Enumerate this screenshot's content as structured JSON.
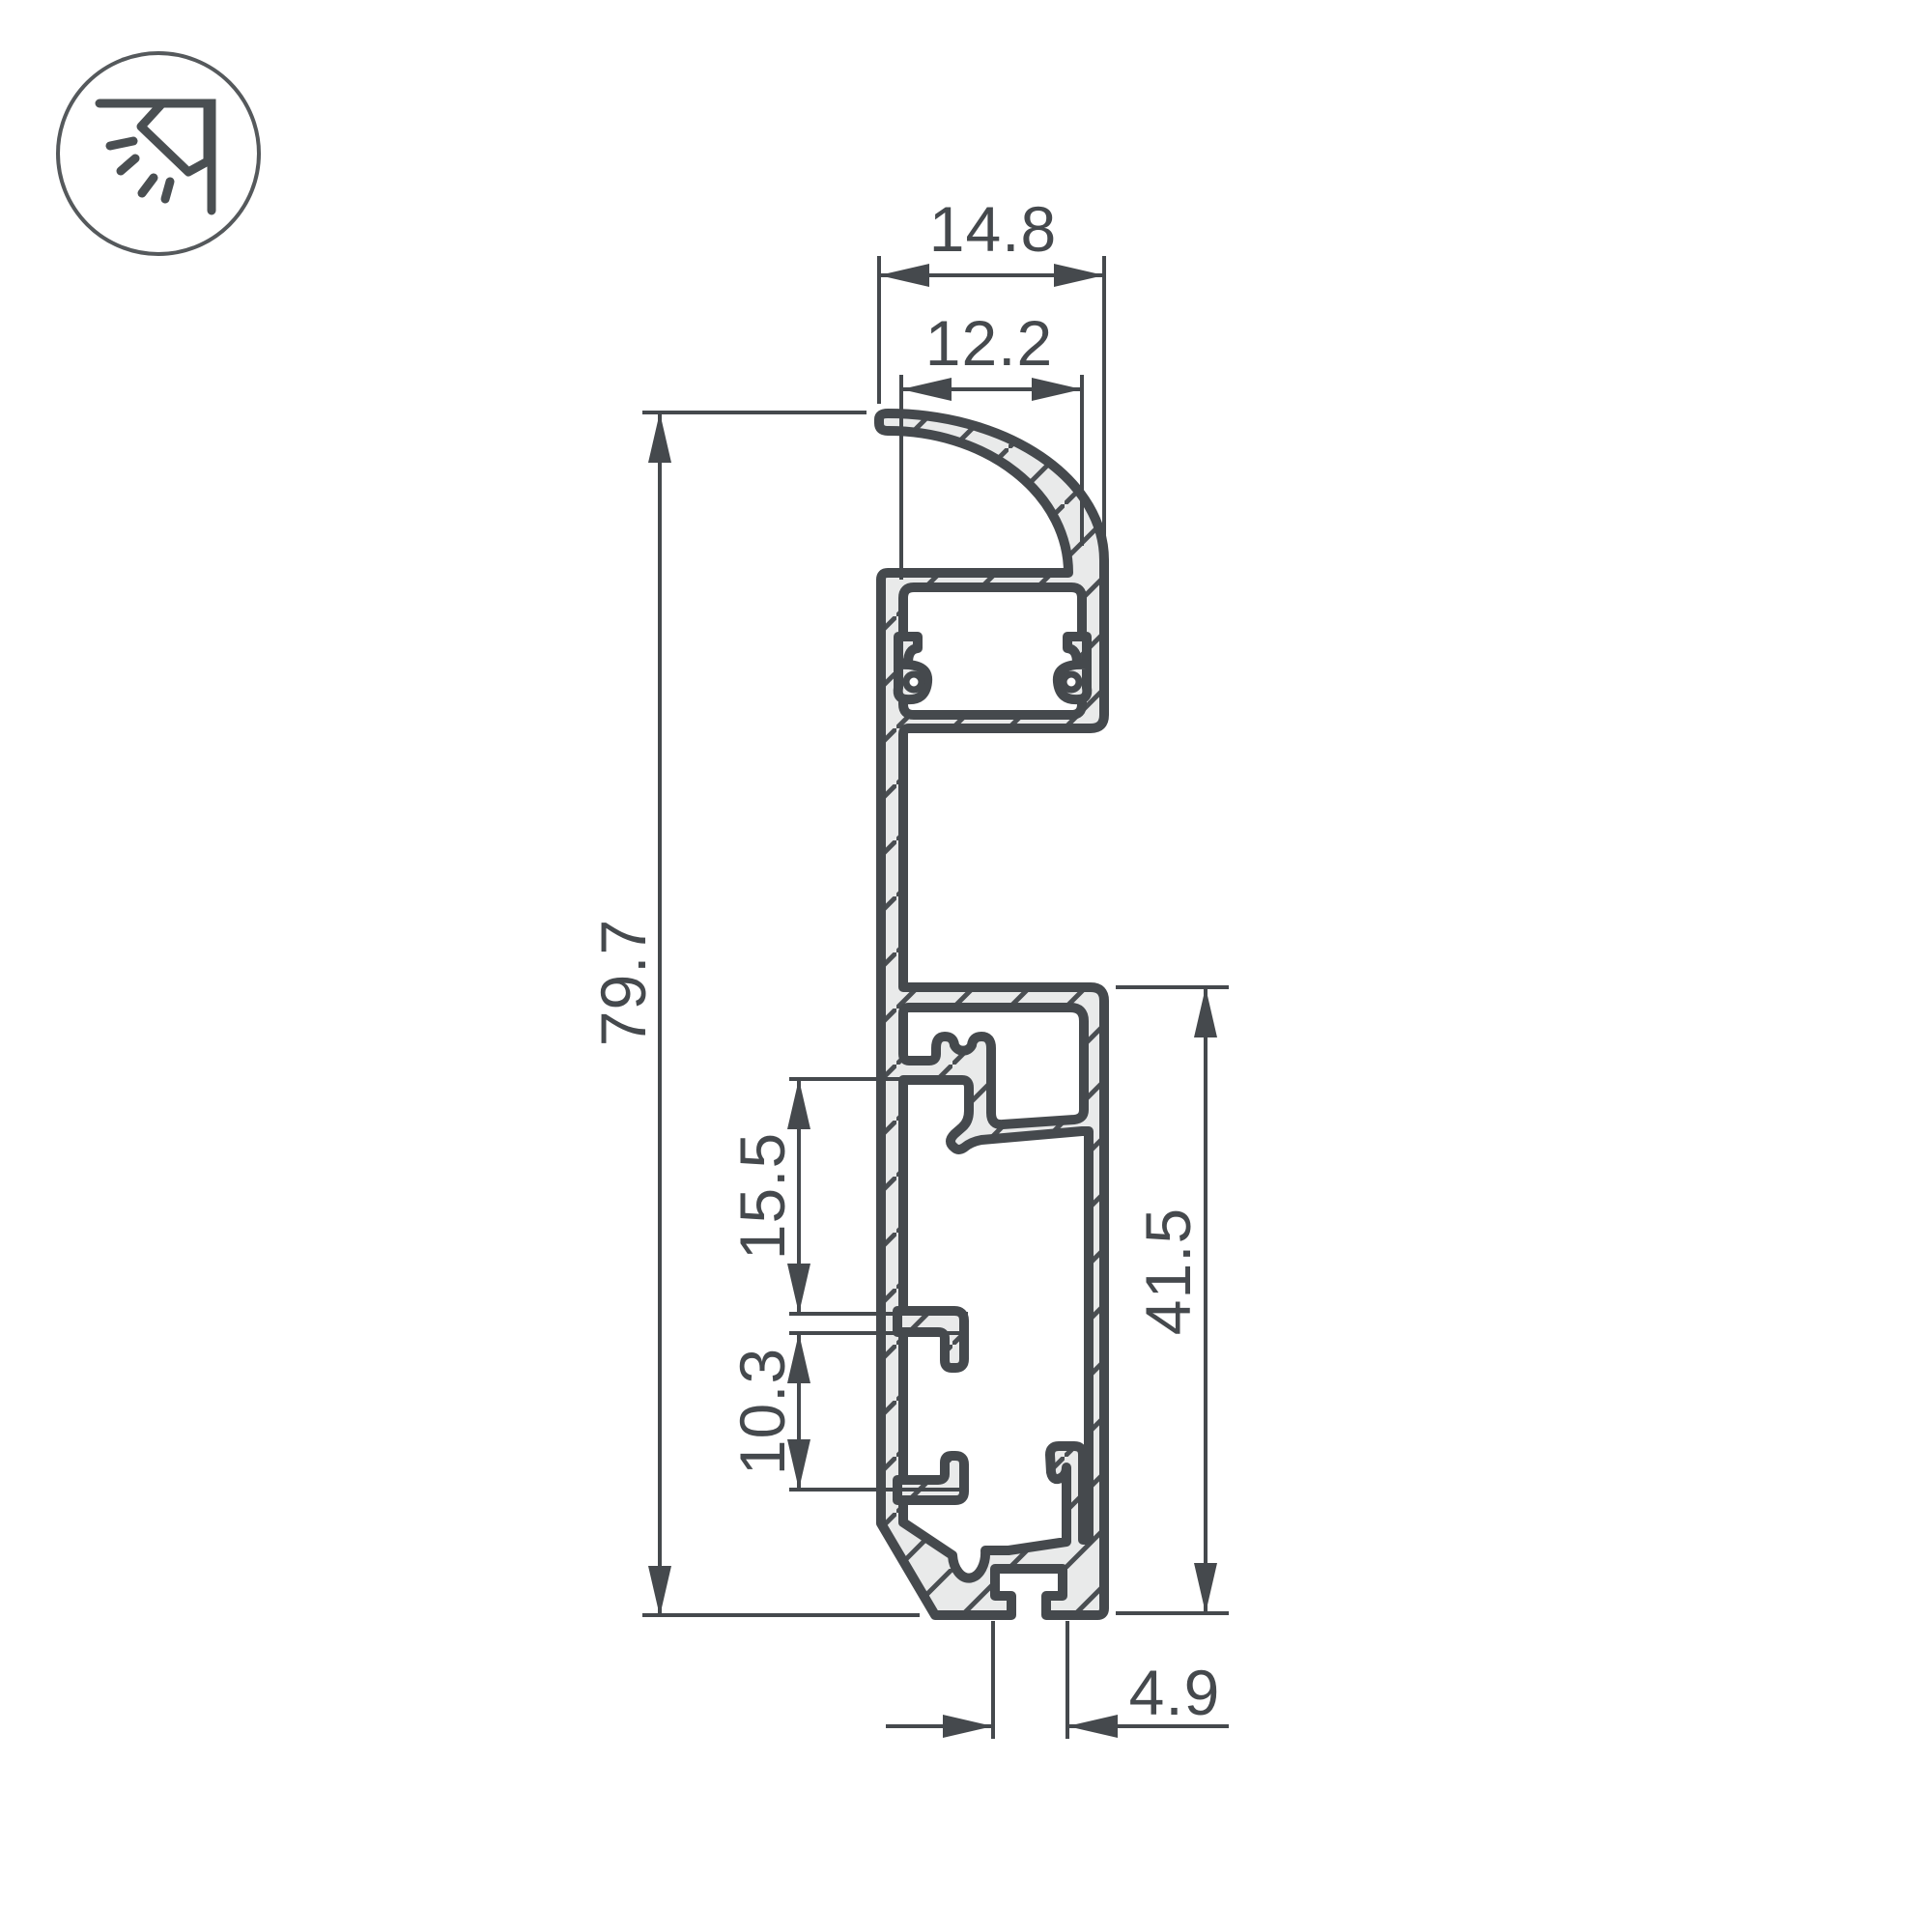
{
  "icon": {
    "name": "wall-mounted-light-icon"
  },
  "drawing": {
    "type": "technical-cross-section",
    "dimensions": {
      "top_width_outer": {
        "label": "14.8"
      },
      "top_width_inner": {
        "label": "12.2"
      },
      "overall_height": {
        "label": "79.7"
      },
      "clip_to_hook_spacing": {
        "label": "15.5"
      },
      "hook_spacing": {
        "label": "10.3"
      },
      "base_section_height": {
        "label": "41.5"
      },
      "mount_slot_width": {
        "label": "4.9"
      }
    },
    "style": {
      "line_color": "#45494d",
      "metal_fill": "#e9eaea",
      "background": "#ffffff"
    }
  }
}
